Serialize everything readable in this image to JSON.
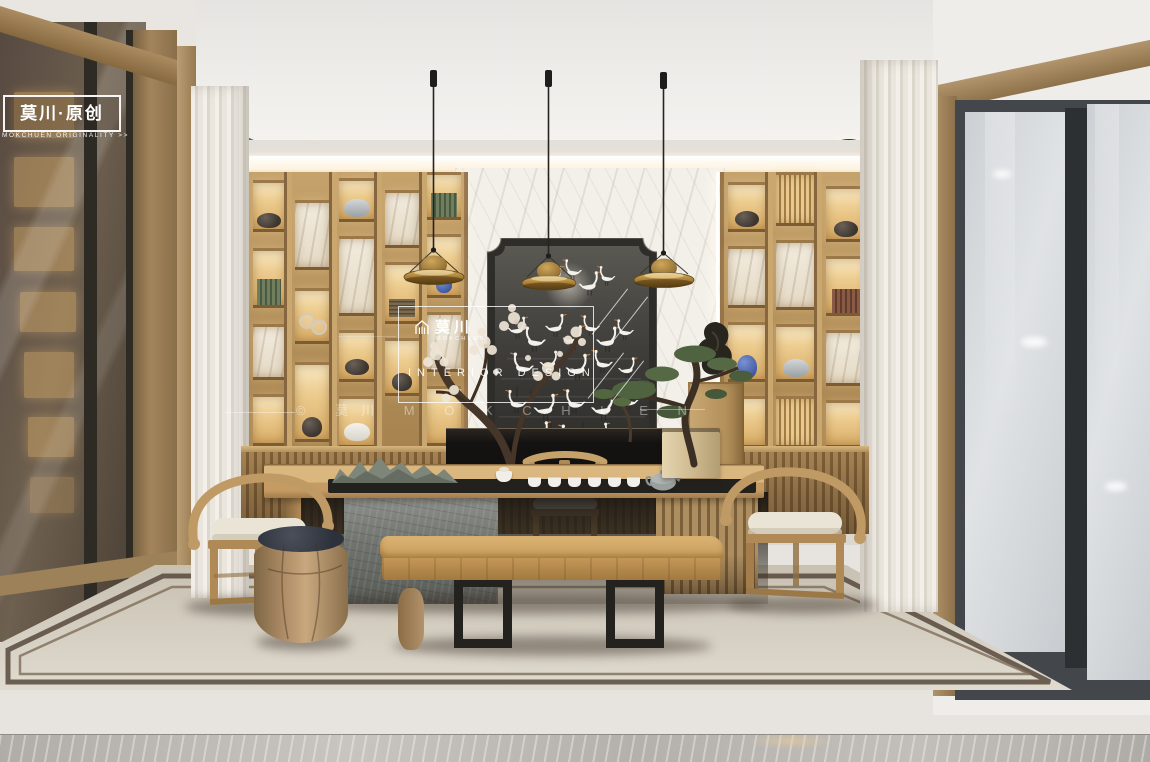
{
  "logo": {
    "title_cn": "莫川·原创",
    "subtitle_en": "MOKCHUEN ORIGINALITY >>"
  },
  "watermark": {
    "brand_cn": "莫川",
    "brand_en": "MOKCHUEN",
    "caption": "INTERIOR DESIGN",
    "diagonal": "© 莫川 M O K C H U E N"
  },
  "scene": {
    "objects": [
      "pendant-lamp",
      "crane-ink-mural",
      "display-shelving",
      "cove-light",
      "recessed-downlight",
      "tea-table",
      "stone-table-base",
      "slat-table-base",
      "tea-set",
      "mountain-sculpture",
      "horseshoe-armchair",
      "host-chair",
      "drum-stool",
      "live-edge-bench",
      "bonsai-pine",
      "blossom-branch",
      "rock-sculpture",
      "side-cabinet",
      "console-table",
      "sheer-curtains",
      "glass-partition",
      "frosted-window",
      "slat-wainscot",
      "area-rug",
      "wood-floor",
      "marble-floor"
    ]
  },
  "colors": {
    "brass": "#b08a3e",
    "wood": "#b9945f",
    "wood-dark": "#8a6b44",
    "wood-light": "#d2ad74",
    "glow": "#f6dba6",
    "wall": "#e7e4df",
    "ceiling": "#edebe8",
    "mural-bg": "#403f3b",
    "crane-white": "#f3f1ec",
    "beak-orange": "#c87f3a",
    "marble-wall": "#f3f0ea",
    "curtain": "#efebe4",
    "stone": "#787b76",
    "cushion": "#e8e3d6",
    "cushion-dark": "#3a3d45",
    "rug": "#d8d2c6",
    "rug-border": "#5f5143",
    "floor-wood": "#937c61",
    "floor-marble": "#b7b4af",
    "glass-cool": "#d4d7da",
    "glass-tinted": "#6a5b4c",
    "frame-dark": "#3e4246",
    "console-black": "#1b1916",
    "pine-green": "#556840",
    "blossom": "#ece2d2"
  }
}
